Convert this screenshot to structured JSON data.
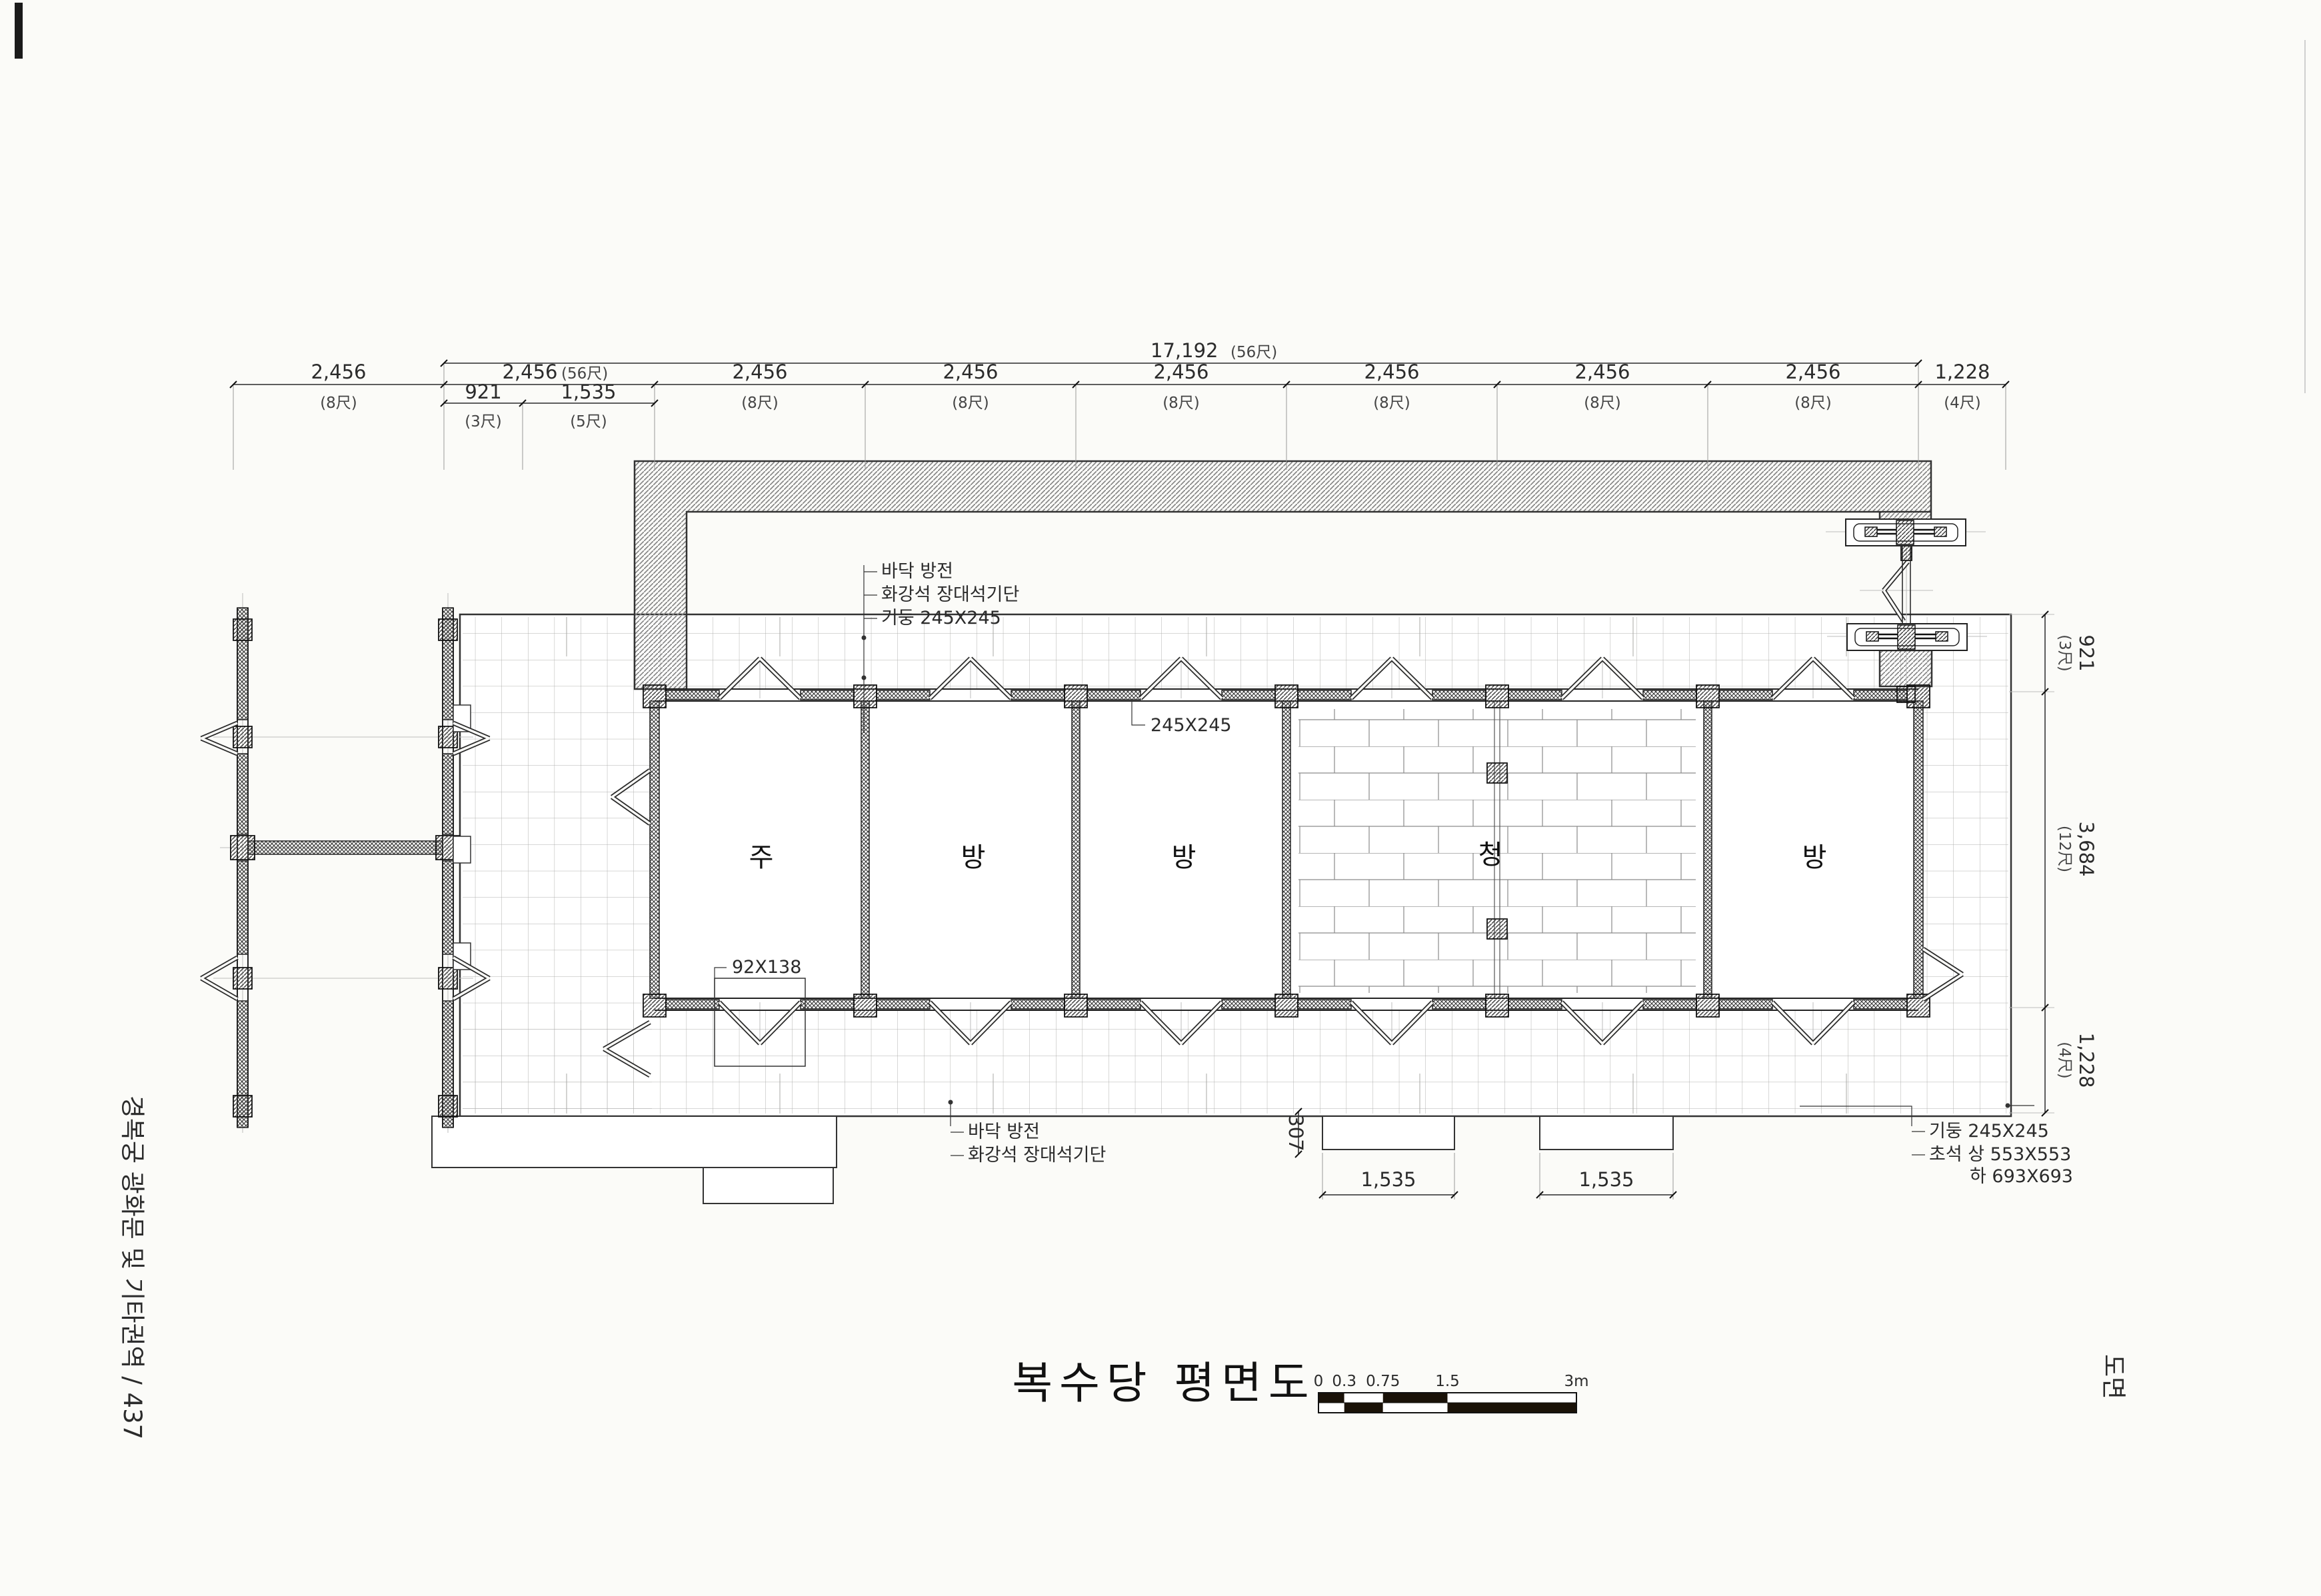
{
  "captions": {
    "left_vertical": "경복궁 광화문 및 기타권역 / 437",
    "right_vertical": "도면"
  },
  "title": {
    "text": "복수당 평면도"
  },
  "scalebar": {
    "labels": [
      "0",
      "0.3",
      "0.75",
      "1.5",
      "3m"
    ]
  },
  "dims": {
    "top_total": {
      "value": "17,192",
      "unit": "(56尺)"
    },
    "top_bays": [
      {
        "value": "2,456",
        "unit": "(8尺)"
      },
      {
        "value": "2,456",
        "unit": "(56尺)"
      },
      {
        "value": "2,456",
        "unit": "(8尺)"
      },
      {
        "value": "2,456",
        "unit": "(8尺)"
      },
      {
        "value": "2,456",
        "unit": "(8尺)"
      },
      {
        "value": "2,456",
        "unit": "(8尺)"
      },
      {
        "value": "2,456",
        "unit": "(8尺)"
      },
      {
        "value": "2,456",
        "unit": "(8尺)"
      },
      {
        "value": "1,228",
        "unit": "(4尺)"
      }
    ],
    "top_sub": [
      {
        "value": "921",
        "unit": "(3尺)"
      },
      {
        "value": "1,535",
        "unit": "(5尺)"
      }
    ],
    "right": [
      {
        "value": "921",
        "unit": "(3尺)"
      },
      {
        "value": "3,684",
        "unit": "(12尺)"
      },
      {
        "value": "1,228",
        "unit": "(4尺)"
      }
    ],
    "bottom": {
      "step_height": "307",
      "steps": [
        "1,535",
        "1,535"
      ]
    }
  },
  "annotations": {
    "top": [
      "바닥 방전",
      "화강석 장대석기단",
      "기둥 245X245"
    ],
    "column_size": "245X245",
    "door_member": "92X138",
    "bottom": [
      "바닥 방전",
      "화강석 장대석기단"
    ],
    "bottom_right": [
      "기둥 245X245",
      "초석 상 553X553",
      "하 693X693"
    ]
  },
  "rooms": [
    {
      "label": "주"
    },
    {
      "label": "방"
    },
    {
      "label": "방"
    },
    {
      "label": "청"
    },
    {
      "label": "방"
    }
  ]
}
